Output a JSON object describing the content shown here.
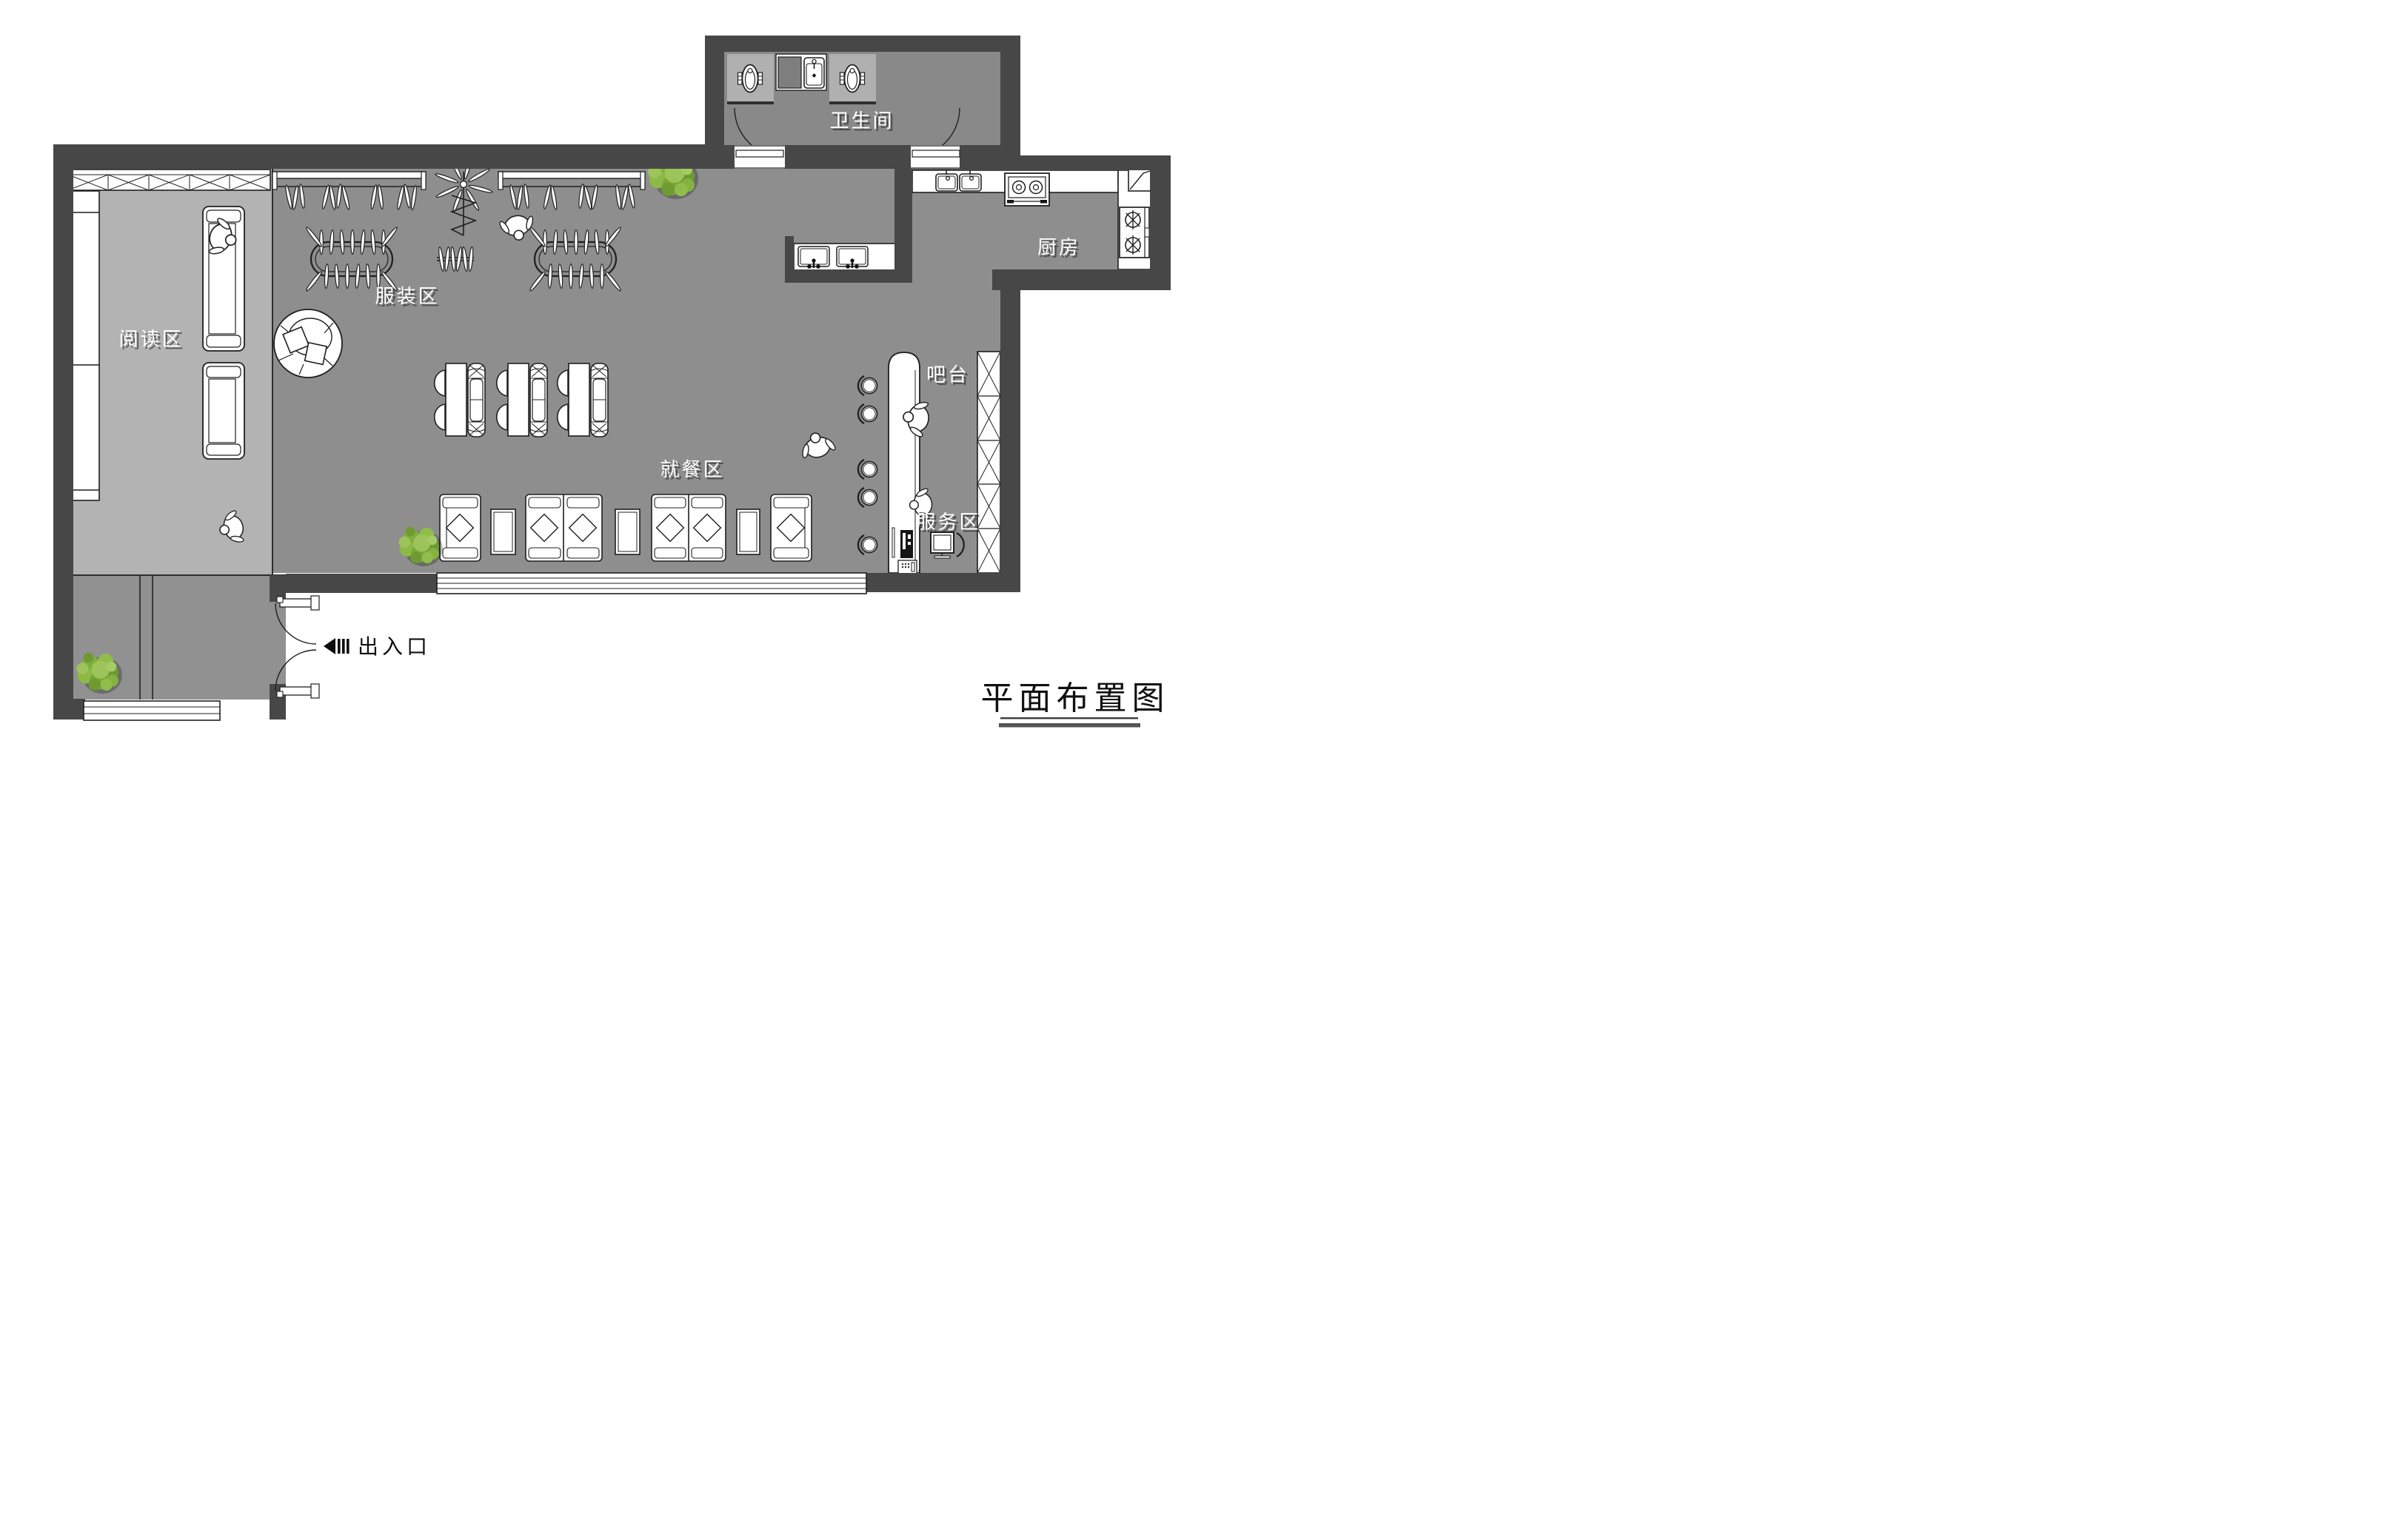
{
  "title": {
    "text": "平面布置图"
  },
  "area_labels": {
    "bathroom": "卫生间",
    "kitchen": "厨房",
    "reading": "阅读区",
    "clothing": "服装区",
    "dining": "就餐区",
    "bar": "吧台",
    "service": "服务区",
    "entrance": "出入口"
  },
  "colors": {
    "wall": "#474747",
    "floor_main": "#8e8e8e",
    "floor_light": "#b3b3b3",
    "floor_bathroom": "#898989",
    "outline": "#1f1f1f",
    "furniture_fill": "#ffffff",
    "label_text": "#ffffff",
    "label_shadow": "#3c3c3c",
    "title_text": "#111111",
    "plant_green_light": "#9cc45a",
    "plant_green_dark": "#6e9a31"
  },
  "furniture": {
    "dining_table_sets": 3,
    "booth_sofas": 3,
    "dining_chairs": 6,
    "lounge_sofa_units": 4,
    "lounge_side_tables": 3,
    "bar_stools": 5,
    "reading_sofas": 2,
    "round_lounge_chair": 1,
    "clothing_wall_racks": 2,
    "clothing_oval_racks": 2,
    "clothing_rotating_racks": 1,
    "clothing_small_racks": 1,
    "squat_toilets": 2,
    "hand_wash_basins": 2,
    "kitchen_sink_bowls": 2,
    "stove_burners": 2,
    "gas_burners": 2,
    "display_shelf_cells": 5,
    "windows": 2,
    "plants": 3,
    "people": 6
  }
}
